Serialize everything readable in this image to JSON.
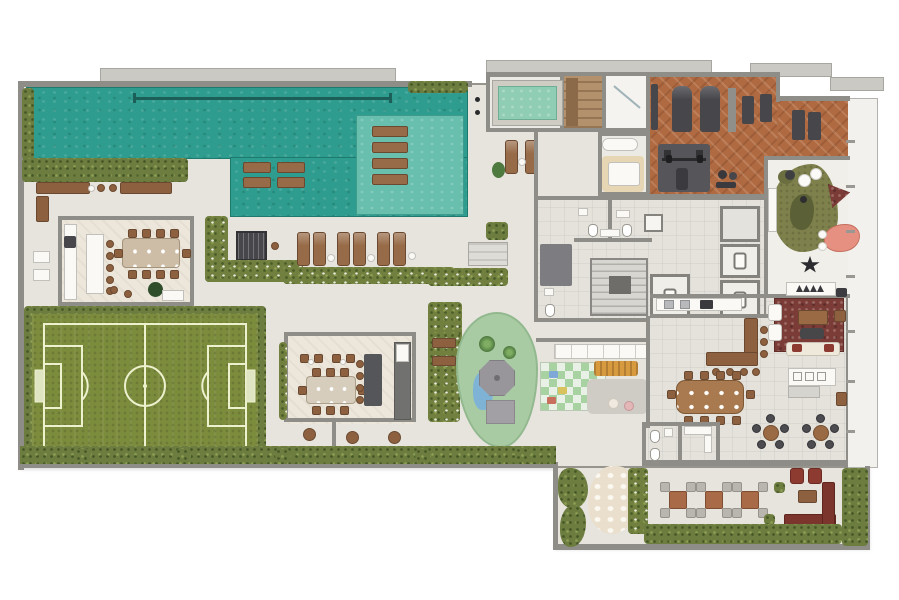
{
  "scene": {
    "type": "architectural-floor-plan-render",
    "view": "top-down 3D render of residential amenities floor, no text labels"
  },
  "palette": {
    "background": "#ffffff",
    "deck": "#e7e4de",
    "plate_border": "#97948d",
    "parapet": "#cbc9c3",
    "balcony": "#f2f1ed",
    "wall": "#8f8d88",
    "indoor": "#eceae4",
    "indoor_warm": "#ece6db",
    "tile": "#e4e2db",
    "pool": "#2e9c8e",
    "pool_shelf": "#68bfae",
    "lane_line": "#1c5f58",
    "kids_pool": "#90cdb5",
    "hedge": "#6d7d40",
    "grass_field": "#7c8c3d",
    "field_line": "#edf1cd",
    "gym_wood": "#b06a42",
    "wood_furniture": "#8d6140",
    "wood_table": "#a97a4f",
    "white_furniture": "#faf9f6",
    "equipment": "#46464b",
    "rug_red": "#7b3b37",
    "rug_olive": "#7e814c",
    "play_green": "#a9cba4",
    "checker_green": "#a8d2a2",
    "orange_bench": "#d89a3f",
    "coral_table": "#e59080",
    "fire_red": "#8d3a30",
    "sauna_wood": "#b3916c",
    "massage_rug": "#e6d6b4",
    "water_slide_blue": "#7fb3d6",
    "garden_path": "#e9dfcc",
    "steel": "#b7b9bb"
  },
  "areas": [
    {
      "id": "lap-pool"
    },
    {
      "id": "wet-deck-loungers"
    },
    {
      "id": "kids-pool"
    },
    {
      "id": "sauna"
    },
    {
      "id": "shower-room"
    },
    {
      "id": "massage-room"
    },
    {
      "id": "fitness-gym"
    },
    {
      "id": "stair-core"
    },
    {
      "id": "elevator-bank"
    },
    {
      "id": "restrooms"
    },
    {
      "id": "gourmet-lounge-west"
    },
    {
      "id": "bbq-grill"
    },
    {
      "id": "sun-lounger-row"
    },
    {
      "id": "mini-soccer-field"
    },
    {
      "id": "gourmet-lounge-center"
    },
    {
      "id": "playground"
    },
    {
      "id": "kids-play-area"
    },
    {
      "id": "indoor-kids-room"
    },
    {
      "id": "living-lounge"
    },
    {
      "id": "party-hall"
    },
    {
      "id": "kitchen"
    },
    {
      "id": "bar-counter"
    },
    {
      "id": "outdoor-terrace"
    },
    {
      "id": "fire-pit-lounge"
    },
    {
      "id": "garden-path"
    },
    {
      "id": "perimeter-hedges"
    }
  ]
}
